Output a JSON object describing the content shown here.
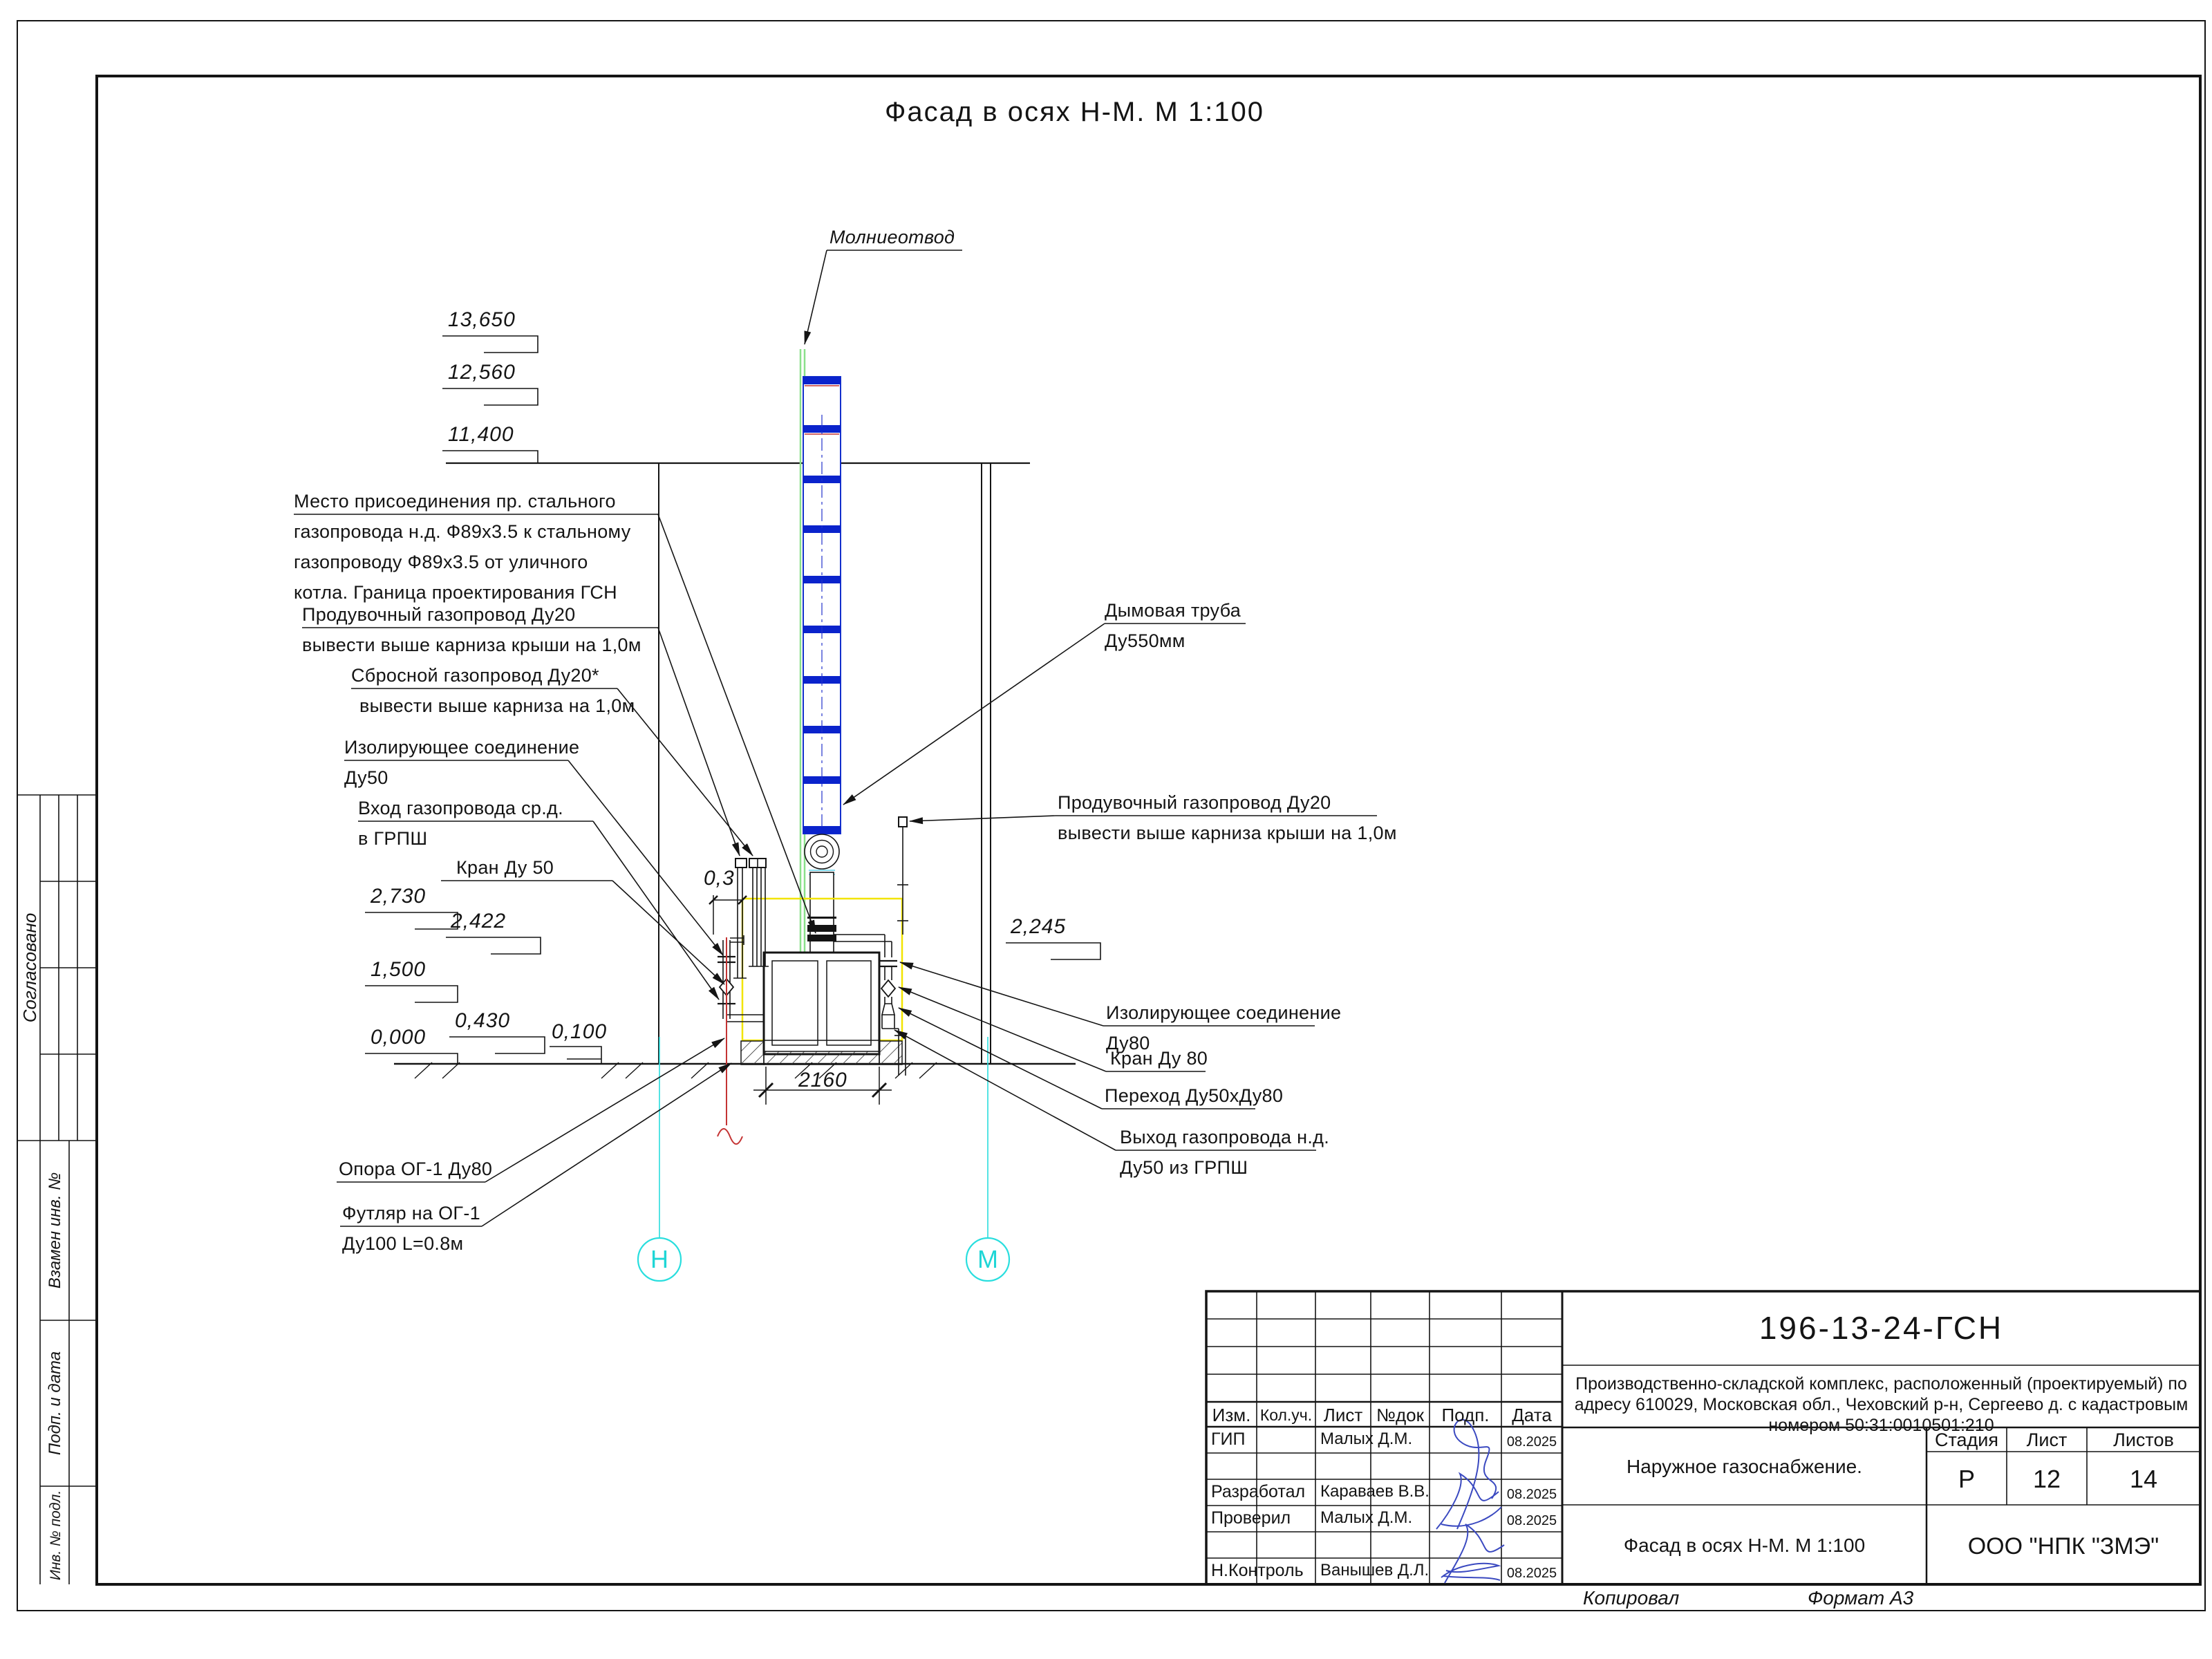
{
  "page": {
    "title": "Фасад в осях Н-М. М 1:100",
    "copied": "Копировал",
    "format": "Формат А3"
  },
  "sidebar": {
    "agreed": "Согласовано",
    "replace": "Взамен инв. №",
    "sign_date": "Подп. и дата",
    "inv": "Инв. № подл."
  },
  "marks": {
    "m13650": "13,650",
    "m12560": "12,560",
    "m11400": "11,400",
    "m2730": "2,730",
    "m2422": "2,422",
    "m1500": "1,500",
    "m0430": "0,430",
    "m0000": "0,000",
    "m0100": "0,100",
    "m2245": "2,245"
  },
  "dims": {
    "width": "2160",
    "gap": "0,3"
  },
  "axes": {
    "left": "Н",
    "right": "М"
  },
  "callouts": {
    "lightning": "Молниеотвод",
    "connect": [
      "Место присоединения пр. стального",
      "газопровода н.д. Ф89х3.5 к стальному",
      "газопроводу Ф89х3.5 от уличного",
      "котла. Граница проектирования ГСН"
    ],
    "purge_left": [
      "Продувочный газопровод Ду20",
      "вывести выше карниза крыши на 1,0м"
    ],
    "relief": [
      "Сбросной газопровод Ду20*",
      "вывести выше карниза на 1,0м"
    ],
    "insul50": [
      "Изолирующее соединение",
      "Ду50"
    ],
    "inlet": [
      "Вход газопровода ср.д.",
      "в ГРПШ"
    ],
    "valve50": "Кран Ду 50",
    "flue": [
      "Дымовая труба",
      "Ду550мм"
    ],
    "purge_right": [
      "Продувочный газопровод Ду20",
      "вывести выше карниза крыши на 1,0м"
    ],
    "insul80": [
      "Изолирующее соединение",
      "Ду80"
    ],
    "valve80": "Кран Ду 80",
    "reducer": "Переход Ду50хДу80",
    "outlet": [
      "Выход газопровода н.д.",
      "Ду50 из ГРПШ"
    ],
    "support": "Опора ОГ-1 Ду80",
    "casing": [
      "Футляр на ОГ-1",
      "Ду100 L=0.8м"
    ]
  },
  "titleblock": {
    "doc": "196-13-24-ГСН",
    "project": [
      "Производственно-складской комплекс, расположенный (проектируемый) по",
      "адресу 610029, Московская обл., Чеховский р-н, Сергеево д. с кадастровым",
      "номером 50:31:0010501:210"
    ],
    "section": "Наружное газоснабжение.",
    "drawing": "Фасад в осях Н-М. М 1:100",
    "company": "ООО \"НПК \"ЗМЭ\"",
    "stage_h": "Стадия",
    "sheet_h": "Лист",
    "sheets_h": "Листов",
    "stage": "Р",
    "sheet": "12",
    "sheets": "14",
    "cols": [
      "Изм.",
      "Кол.уч.",
      "Лист",
      "№док",
      "Подп.",
      "Дата"
    ],
    "rows": [
      {
        "role": "ГИП",
        "name": "Малых Д.М.",
        "date": "08.2025"
      },
      {
        "role": "Разработал",
        "name": "Караваев В.В.",
        "date": "08.2025"
      },
      {
        "role": "Проверил",
        "name": "Малых Д.М.",
        "date": "08.2025"
      },
      {
        "role": "Н.Контроль",
        "name": "Ванышев Д.Л.",
        "date": "08.2025"
      }
    ]
  }
}
